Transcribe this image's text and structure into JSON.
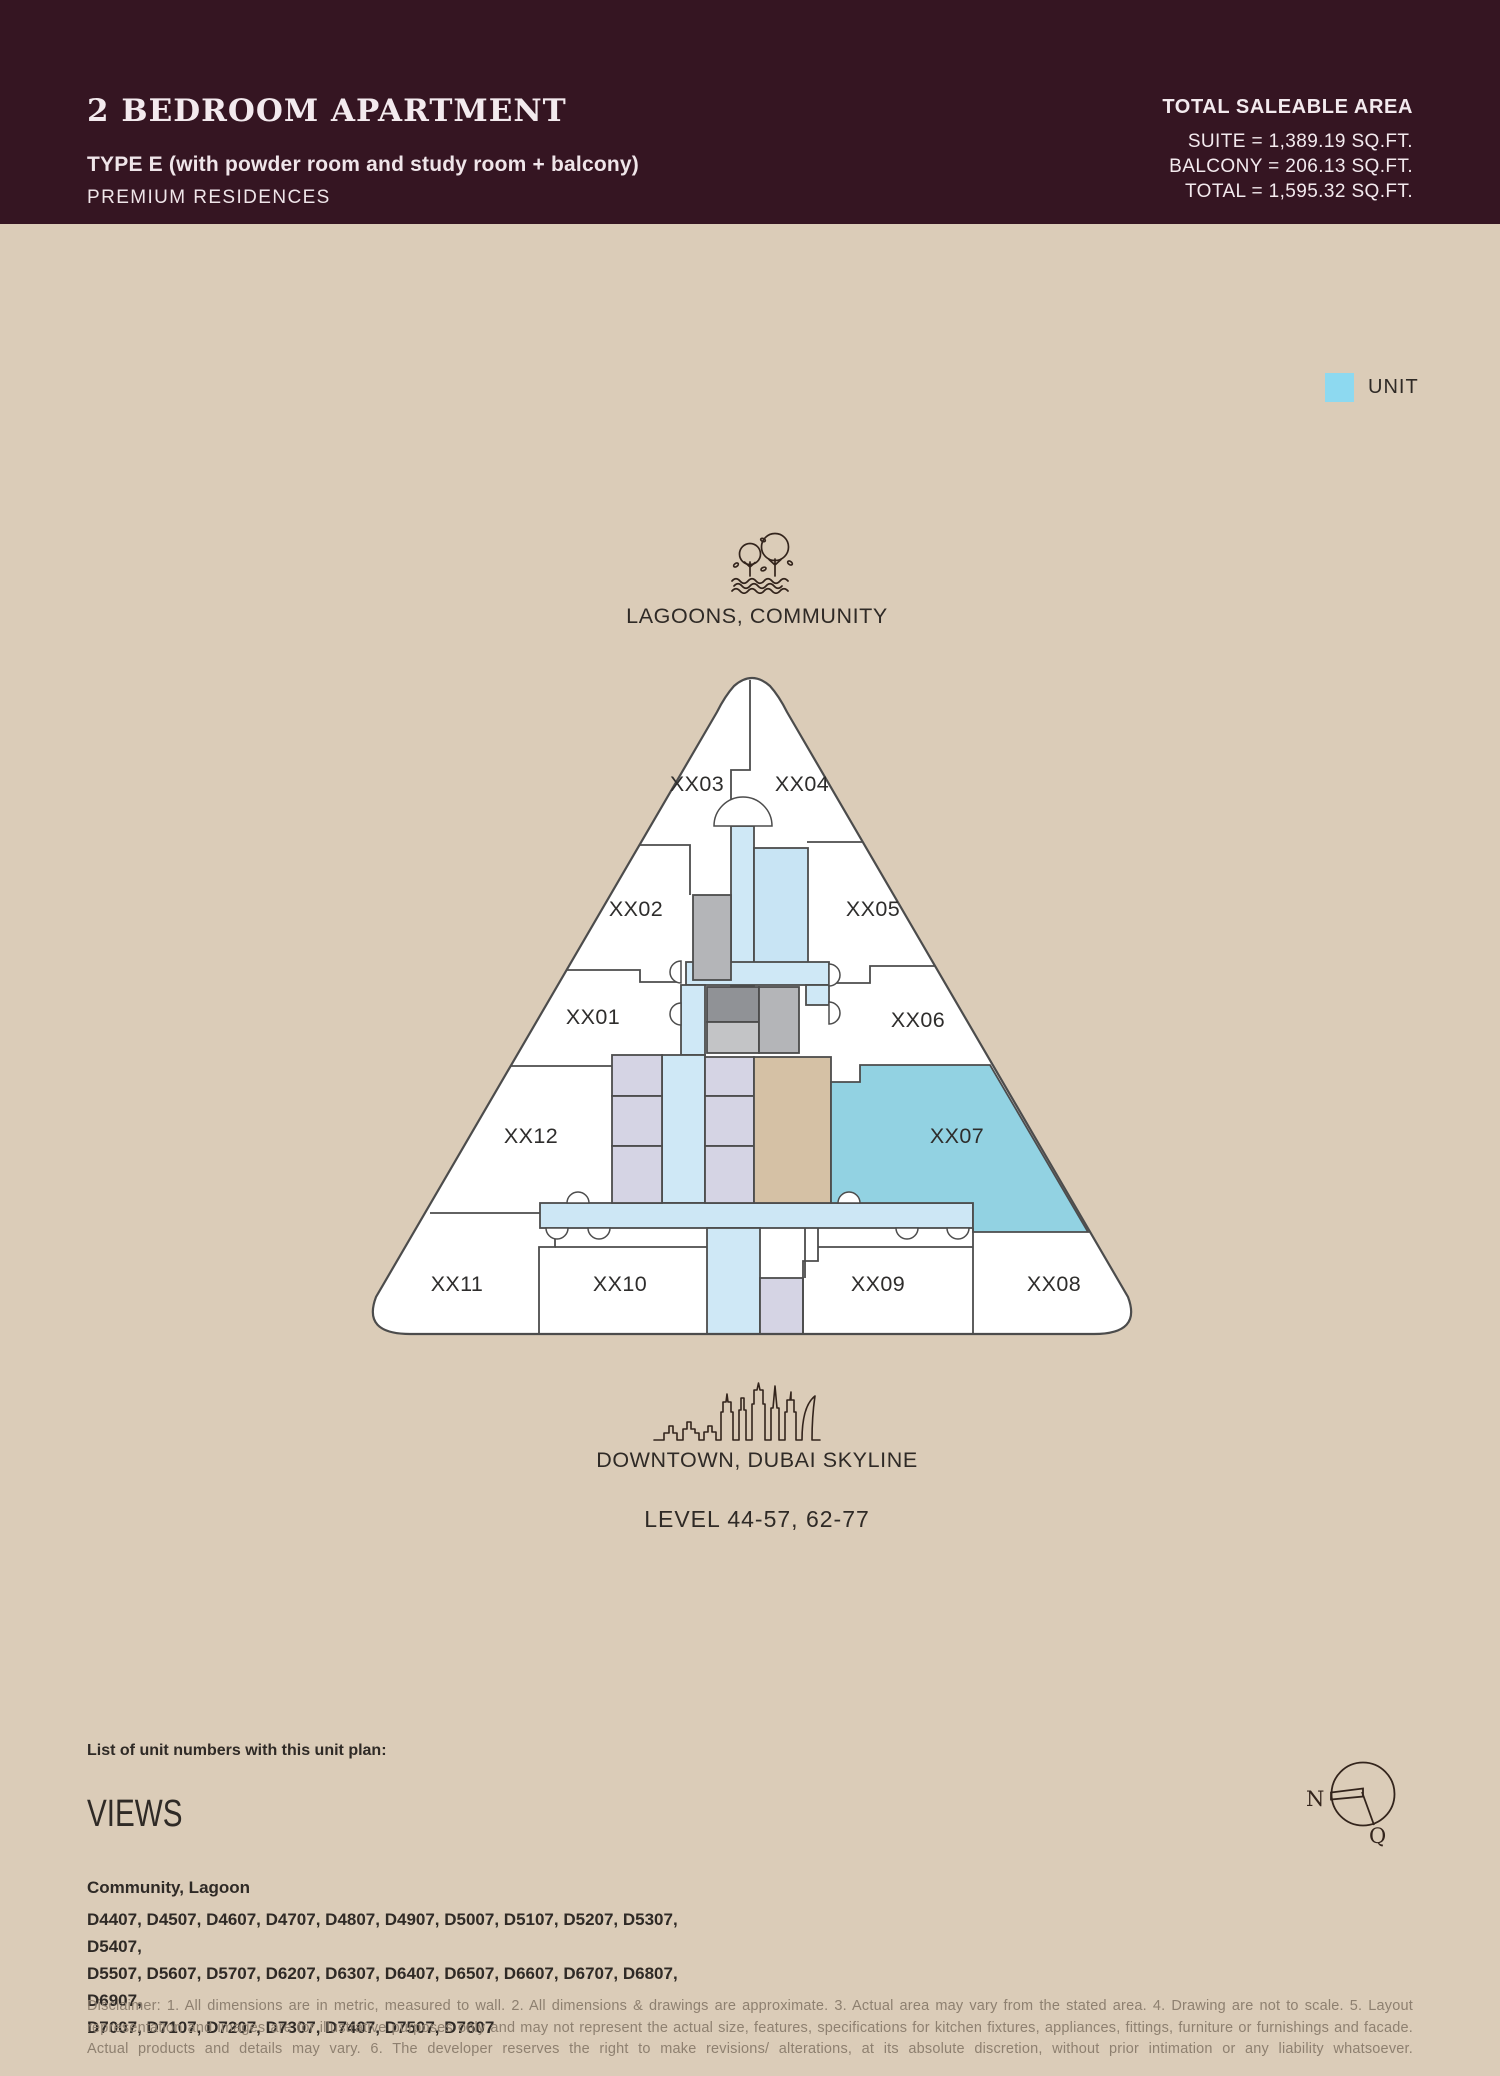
{
  "header": {
    "title": "2 BEDROOM APARTMENT",
    "subtitle": "TYPE E (with powder room and study room + balcony)",
    "brand": "PREMIUM RESIDENCES",
    "area": {
      "label": "TOTAL SALEABLE AREA",
      "suite": "SUITE = 1,389.19 SQ.FT.",
      "balcony": "BALCONY = 206.13 SQ.FT.",
      "total": "TOTAL = 1,595.32 SQ.FT."
    }
  },
  "legend": {
    "label": "UNIT",
    "swatch_color": "#8dd9f0"
  },
  "plan": {
    "top_label": "LAGOONS, COMMUNITY",
    "bottom_label": "DOWNTOWN, DUBAI SKYLINE",
    "level_label": "LEVEL 44-57, 62-77",
    "unit_labels": [
      "XX01",
      "XX02",
      "XX03",
      "XX04",
      "XX05",
      "XX06",
      "XX07",
      "XX08",
      "XX09",
      "XX10",
      "XX11",
      "XX12"
    ],
    "highlighted_unit": "XX07",
    "colors": {
      "unit_highlight": "#92d2e2",
      "corridor_blue": "#cfe8f6",
      "service_lavender": "#d5d4e4",
      "core_gray_dark": "#909296",
      "core_gray_light": "#b4b5b8",
      "center_tan": "#d5c1a5",
      "page_background": "#dbccb8",
      "header_background": "#351522"
    }
  },
  "footer": {
    "list_label": "List of unit numbers with this unit plan:",
    "views_title": "VIEWS",
    "views_value": "Community, Lagoon",
    "unit_numbers": "D4407, D4507, D4607, D4707, D4807, D4907, D5007, D5107, D5207, D5307, D5407,\nD5507, D5607, D5707, D6207, D6307, D6407, D6507, D6607, D6707, D6807, D6907,\nD7007, D7107, D7207, D7307, D7407, D7507, D7607",
    "disclaimer": "Disclaimer: 1. All dimensions are in metric, measured to wall. 2. All dimensions & drawings are approximate. 3. Actual area may vary from the stated area. 4. Drawing are not to scale. 5. Layout representation and images are for illustrative purposes only and may not represent the actual size, features, specifications for kitchen fixtures, appliances, fittings, furniture or furnishings and facade. Actual products and details may vary. 6. The developer reserves the right to make revisions/ alterations, at its absolute discretion, without prior intimation or any liability whatsoever."
  },
  "compass": {
    "north_label": "N",
    "q_label": "Q"
  }
}
